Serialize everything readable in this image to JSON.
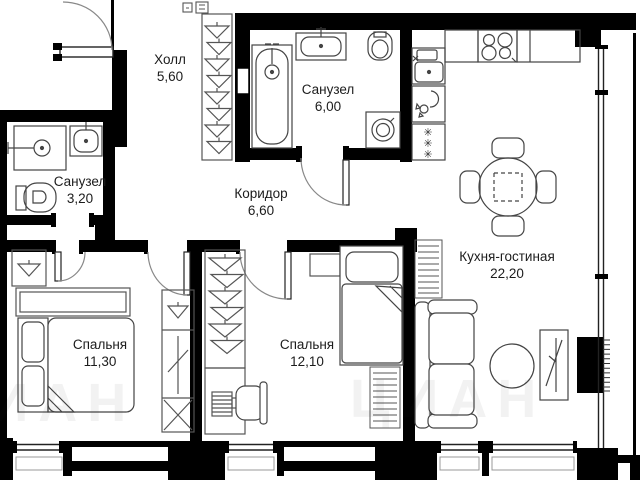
{
  "page": {
    "type": "apartment-floor-plan"
  },
  "watermark": {
    "text": "ЦИАН"
  },
  "rooms": [
    {
      "id": "hall",
      "name": "Холл",
      "area": "5,60"
    },
    {
      "id": "bathroom-large",
      "name": "Санузел",
      "area": "6,00"
    },
    {
      "id": "bathroom-small",
      "name": "Санузел",
      "area": "3,20"
    },
    {
      "id": "corridor",
      "name": "Коридор",
      "area": "6,60"
    },
    {
      "id": "kitchen-living",
      "name": "Кухня-гостиная",
      "area": "22,20"
    },
    {
      "id": "bedroom-1",
      "name": "Спальня",
      "area": "11,30"
    },
    {
      "id": "bedroom-2",
      "name": "Спальня",
      "area": "12,10"
    }
  ],
  "icons": {
    "freezer_mark": "✳"
  }
}
